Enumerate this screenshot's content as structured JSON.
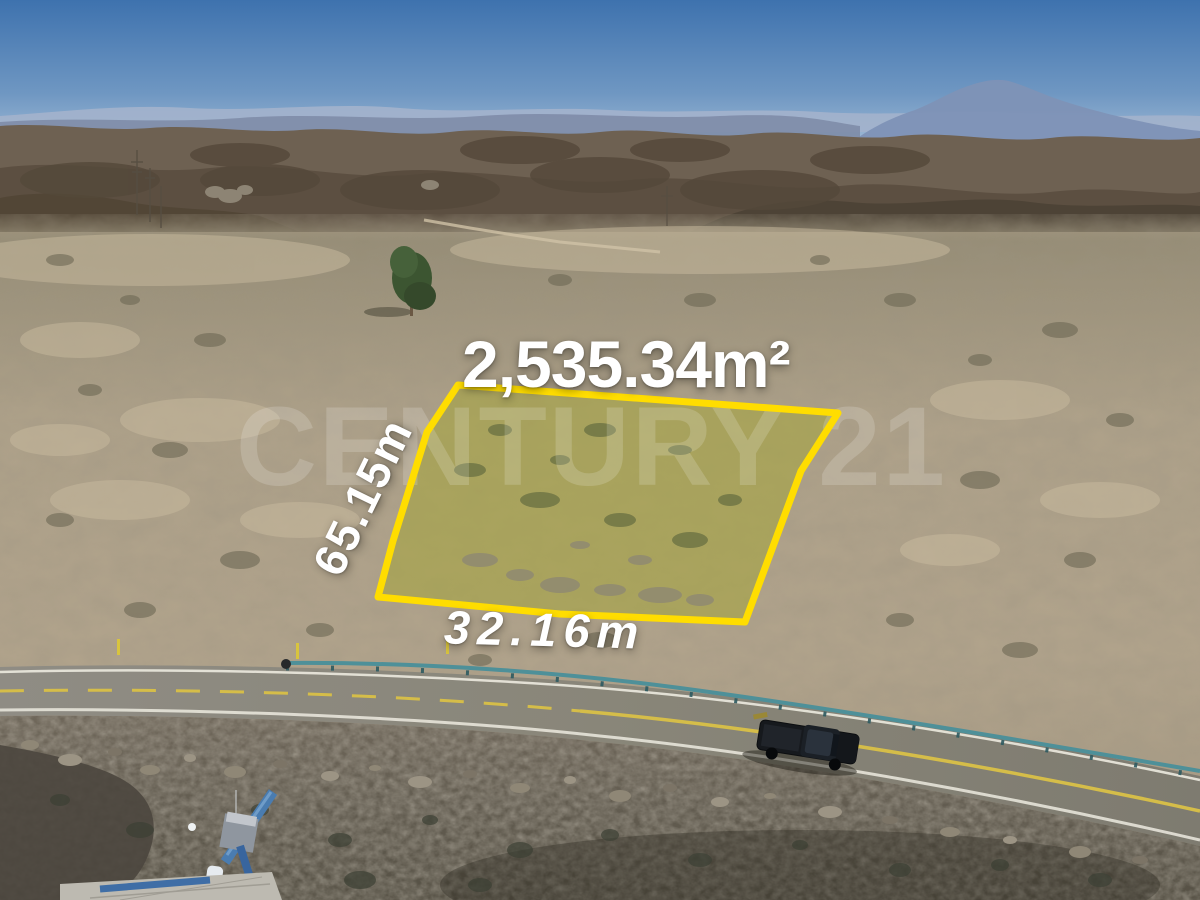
{
  "listing": {
    "area_label": "2,535.34m²",
    "side_length_label": "65.15m",
    "frontage_length_label": "32.16m"
  },
  "watermark": {
    "text": "CENTURY 21"
  },
  "colors": {
    "label_text": "#ffffff",
    "watermark": "rgba(255,255,255,0.17)",
    "lot_outline": "#ffdd00",
    "lot_fill": "rgba(234,220,60,0.25)",
    "lot_vegetation": "#747d42",
    "sky_top": "#3e72ae",
    "sky_mid": "#6f97c2",
    "sky_horizon": "#b7cbdf",
    "guardrail": "#4e9099",
    "road_line_yellow": "#d5bd49",
    "road_line_white": "#eceadf",
    "truck_body": "#16191d"
  }
}
